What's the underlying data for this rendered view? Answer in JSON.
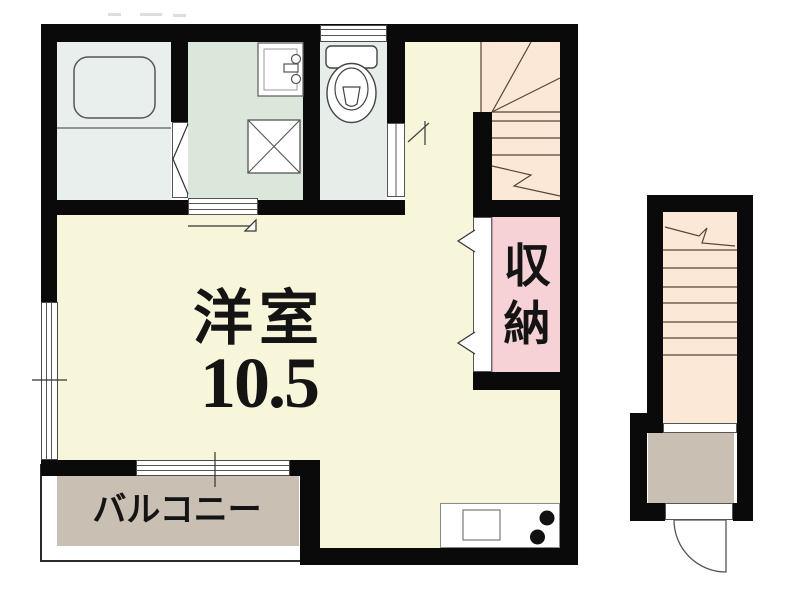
{
  "plan": {
    "type": "floor-plan",
    "labels": {
      "main_room_name": "洋室",
      "main_room_size": "10.5",
      "storage": "収納",
      "balcony": "バルコニー"
    },
    "colors": {
      "wall": "#0a0a0a",
      "main_room": "#f8f6da",
      "bathroom": "#e9efec",
      "washroom": "#dce7dc",
      "toilet": "#e7ede9",
      "staircase": "#fbe8d7",
      "storage": "#f6d2d6",
      "balcony": "#c9bfb3",
      "entrance": "#c9bfb3",
      "fixture_line": "#555555",
      "stair_line": "#5a4436"
    }
  }
}
